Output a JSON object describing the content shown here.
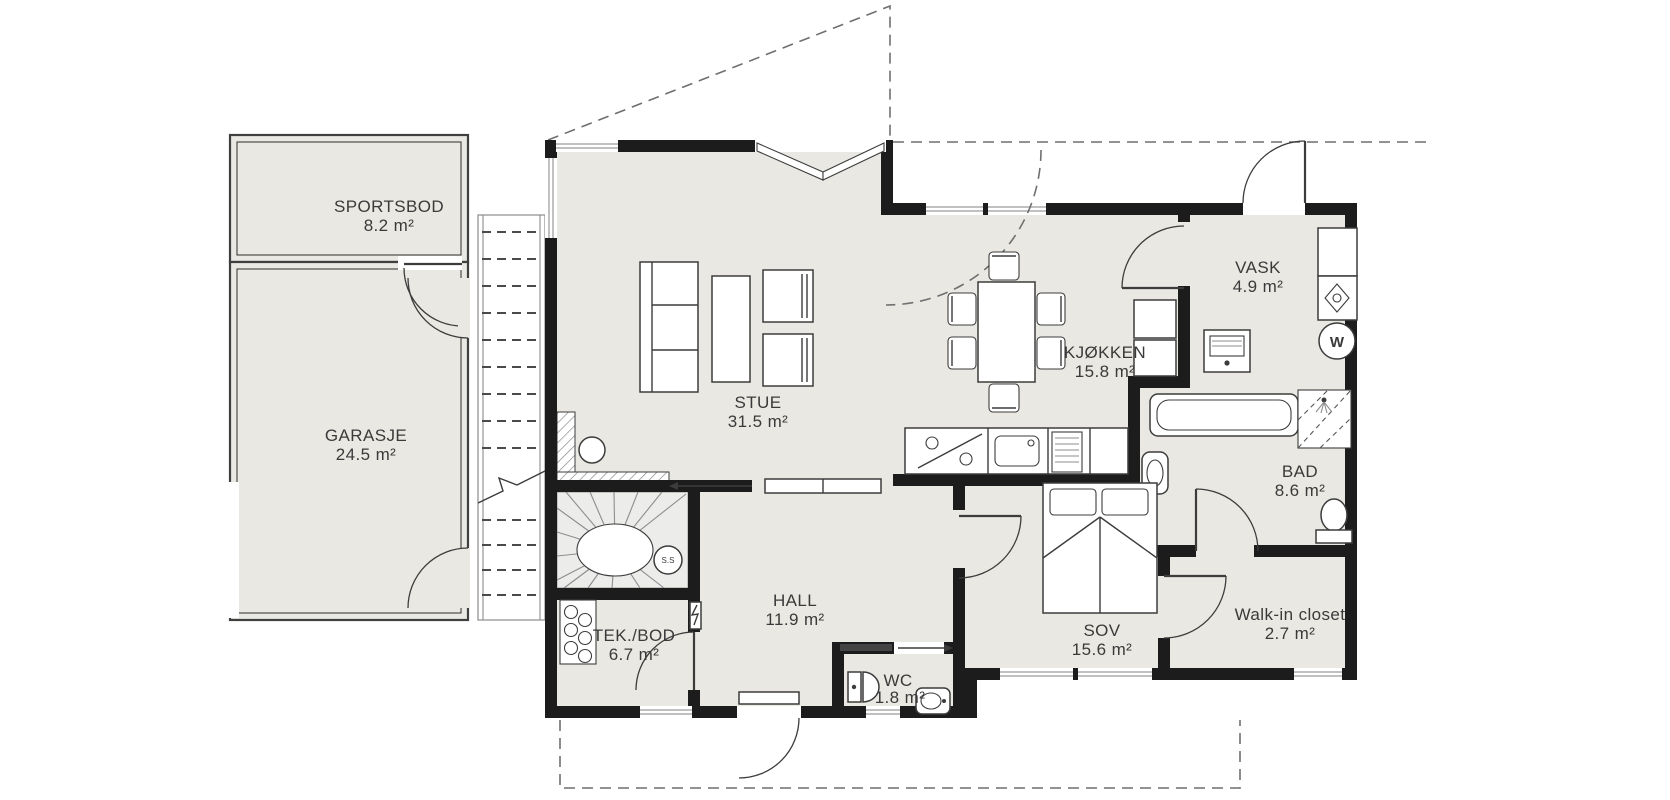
{
  "plan": {
    "type": "floor-plan",
    "language": "Norwegian"
  },
  "colors": {
    "wall": "#1c1c1c",
    "floor": "#eae8e2",
    "line": "#3c3c3c",
    "dashed_guide": "#6f6f6f",
    "text": "#3a3a3a",
    "background": "#ffffff"
  },
  "rooms": [
    {
      "id": "sportsbod",
      "name": "SPORTSBOD",
      "area": "8.2 m²"
    },
    {
      "id": "garasje",
      "name": "GARASJE",
      "area": "24.5 m²"
    },
    {
      "id": "stue",
      "name": "STUE",
      "area": "31.5 m²"
    },
    {
      "id": "kjokken",
      "name": "KJØKKEN",
      "area": "15.8 m²"
    },
    {
      "id": "vask",
      "name": "VASK",
      "area": "4.9 m²"
    },
    {
      "id": "bad",
      "name": "BAD",
      "area": "8.6 m²"
    },
    {
      "id": "hall",
      "name": "HALL",
      "area": "11.9 m²"
    },
    {
      "id": "tekbod",
      "name": "TEK./BOD",
      "area": "6.7 m²"
    },
    {
      "id": "wc",
      "name": "WC",
      "area": "1.8 m²"
    },
    {
      "id": "sov",
      "name": "SOV",
      "area": "15.6 m²"
    },
    {
      "id": "walkin",
      "name": "Walk-in closet",
      "area": "2.7 m²"
    }
  ],
  "annotations": {
    "stair_marker": "S.S",
    "washing_machine": "W"
  }
}
